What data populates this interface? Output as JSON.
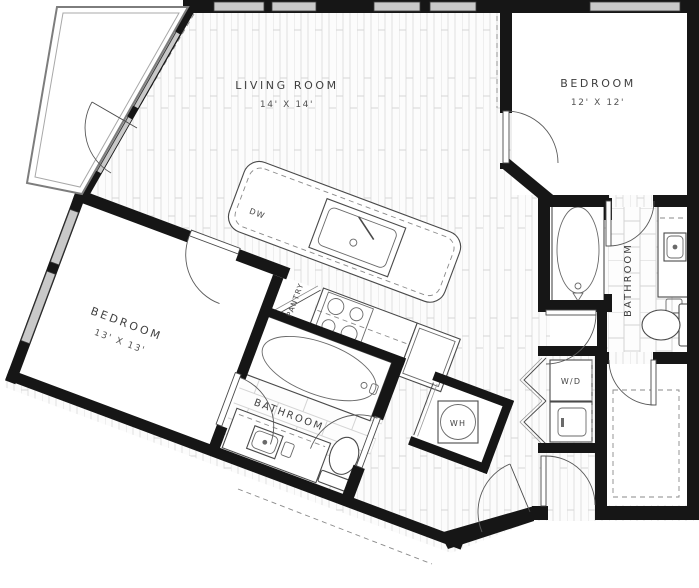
{
  "plan": {
    "type": "apartment-floor-plan",
    "rooms": {
      "living_room": {
        "label": "LIVING ROOM",
        "dimensions": "14' X 14'"
      },
      "bedroom_right": {
        "label": "BEDROOM",
        "dimensions": "12' X 12'"
      },
      "bedroom_left": {
        "label": "BEDROOM",
        "dimensions": "13' X 13'"
      },
      "bathroom_right": {
        "label": "BATHROOM"
      },
      "bathroom_lower": {
        "label": "BATHROOM"
      },
      "pantry": {
        "label": "PANTRY"
      }
    },
    "appliances": {
      "washer_dryer": "W/D",
      "water_heater": "WH",
      "dishwasher": "DW"
    },
    "colors": {
      "wall": "#161616",
      "window_fill": "#c9c9c9",
      "wood_line": "#e0e0e0",
      "tile_line": "#d4d4d4",
      "fixture_line": "#4a4a4a",
      "label_text": "#3f3f3f",
      "background": "#ffffff"
    }
  }
}
